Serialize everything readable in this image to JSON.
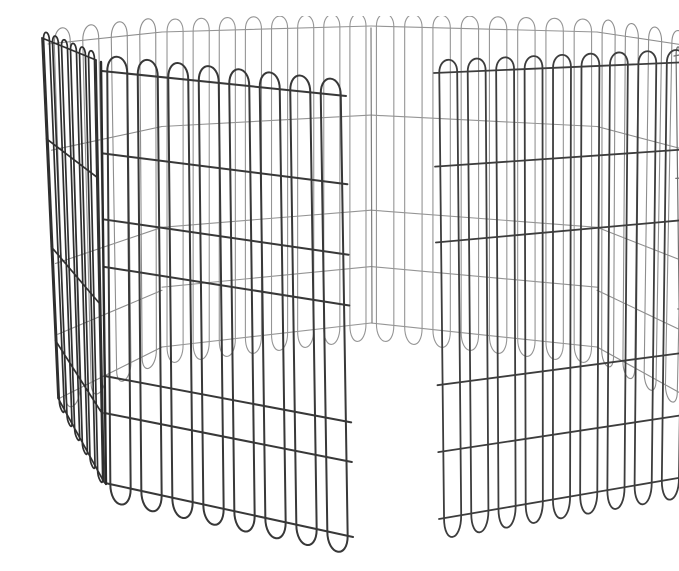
{
  "scene": {
    "alt": "Black metal 8-panel octagonal pet exercise pen with one gate panel swung open inward, photographed on a plain white background",
    "background": "#ffffff",
    "colors": {
      "wire_front": "#383838",
      "wire_door": "#3d3d3d",
      "wire_back": "#959595",
      "wire_diagonal": "#8e8e8e",
      "wire_side_dense": "#2f2f2f",
      "clip_black": "#1c1c1c",
      "corner_post": "#333333",
      "latch_wire": "#2b2b2b"
    }
  },
  "pen": {
    "back_panels": [
      {
        "name": "panel-back-left-diagonal",
        "quad": [
          [
            8,
            28
          ],
          [
            122,
            16
          ],
          [
            122,
            331
          ],
          [
            20,
            382
          ]
        ],
        "loops": 4,
        "pair_gap": 0.14,
        "loop_top": 14,
        "loop_bottom": 13,
        "horizontals": [
          0.3,
          0.62,
          0.82
        ],
        "stroke": "#8e8e8e",
        "width": 1.1,
        "edges": false
      },
      {
        "name": "panel-back-left",
        "quad": [
          [
            122,
            16
          ],
          [
            331,
            10
          ],
          [
            331,
            307
          ],
          [
            122,
            331
          ]
        ],
        "loops": 8,
        "pair_gap": 0.077,
        "loop_top": 12,
        "loop_bottom": 15,
        "horizontals": [
          0.3,
          0.62,
          0.81
        ],
        "stroke": "#959595",
        "width": 1.1,
        "edges": false
      },
      {
        "name": "panel-back-right",
        "quad": [
          [
            331,
            10
          ],
          [
            557,
            16
          ],
          [
            557,
            331
          ],
          [
            331,
            307
          ]
        ],
        "loops": 8,
        "pair_gap": 0.077,
        "loop_top": 12,
        "loop_bottom": 15,
        "horizontals": [
          0.3,
          0.62,
          0.81
        ],
        "stroke": "#959595",
        "width": 1.1,
        "edges": false
      },
      {
        "name": "panel-back-right-diagonal",
        "quad": [
          [
            557,
            16
          ],
          [
            650,
            30
          ],
          [
            642,
            378
          ],
          [
            557,
            331
          ]
        ],
        "loops": 4,
        "pair_gap": 0.14,
        "loop_top": 13,
        "loop_bottom": 12,
        "horizontals": [
          0.3,
          0.62,
          0.82
        ],
        "stroke": "#8e8e8e",
        "width": 1.1,
        "edges": false
      }
    ],
    "back_seam": {
      "name": "back-seam-wire",
      "x1": 331,
      "y1": 12,
      "x2": 332,
      "y2": 307,
      "stroke": "#7d7d7d",
      "width": 1.2
    },
    "mid_panels": [
      {
        "name": "panel-left-side",
        "quad": [
          [
            2,
            22
          ],
          [
            56,
            44
          ],
          [
            64,
            466
          ],
          [
            18,
            382
          ]
        ],
        "loops": 6,
        "pair_gap": 0.11,
        "loop_top": 7,
        "loop_bottom": 5,
        "horizontals": [
          0.28,
          0.58,
          0.84
        ],
        "stroke": "#2f2f2f",
        "width": 1.7,
        "edges": true
      },
      {
        "name": "panel-right-side",
        "quad": [
          [
            634,
            40
          ],
          [
            650,
            37
          ],
          [
            648,
            452
          ],
          [
            640,
            448
          ]
        ],
        "loops": 2,
        "pair_gap": 0.24,
        "loop_top": 8,
        "loop_bottom": 5,
        "horizontals": [
          0.3,
          0.62
        ],
        "stroke": "#707070",
        "width": 1.2,
        "edges": false
      },
      {
        "name": "panel-gate-open",
        "quad": [
          [
            394,
            57
          ],
          [
            650,
            46
          ],
          [
            644,
            461
          ],
          [
            399,
            503
          ]
        ],
        "loops": 9,
        "pair_gap": 0.07,
        "loop_top": 12,
        "loop_bottom": 18,
        "horizontals": [
          0.21,
          0.38,
          0.7,
          0.85
        ],
        "stroke": "#3d3d3d",
        "width": 1.8,
        "edges": false
      }
    ],
    "corner_post": {
      "name": "right-corner-post",
      "points": "664,20 677,23 660,460 650,455",
      "fill": "#333333",
      "highlight": {
        "x1": 669,
        "y1": 28,
        "x2": 656,
        "y2": 450,
        "stroke": "#585858",
        "width": 1.4
      }
    },
    "front_panel": {
      "name": "panel-front-left",
      "quad": [
        [
          62,
          55
        ],
        [
          306,
          80
        ],
        [
          313,
          521
        ],
        [
          65,
          467
        ]
      ],
      "loops": 8,
      "pair_gap": 0.082,
      "loop_top": 15,
      "loop_bottom": 16,
      "horizontals": [
        0.2,
        0.36,
        0.475,
        0.74,
        0.83
      ],
      "stroke": "#383838",
      "width": 2,
      "edges": false
    },
    "edge_wires": [
      {
        "name": "front-left-panel-left-edge",
        "x1": 61,
        "y1": 46,
        "x2": 66,
        "y2": 468,
        "stroke": "#2a2a2a",
        "width": 2.4
      },
      {
        "name": "front-left-panel-right-edge",
        "x1": 305,
        "y1": 62,
        "x2": 314,
        "y2": 523,
        "stroke": "#242424",
        "width": 2.6
      },
      {
        "name": "gate-free-edge",
        "x1": 394,
        "y1": 57,
        "x2": 400,
        "y2": 503,
        "stroke": "#2b2b2b",
        "width": 2.2
      }
    ],
    "clips": [
      {
        "name": "hinge-clip-top-left",
        "x": 118,
        "y": 4,
        "w": 25,
        "h": 13,
        "rot": -3
      },
      {
        "name": "hinge-clip-top-center",
        "x": 318,
        "y": 1,
        "w": 26,
        "h": 13,
        "rot": 0
      },
      {
        "name": "hinge-clip-top-right",
        "x": 527,
        "y": 4,
        "w": 26,
        "h": 13,
        "rot": 4
      },
      {
        "name": "hinge-clip-left-corner",
        "x": 36,
        "y": 35,
        "w": 24,
        "h": 16,
        "rot": 22
      },
      {
        "name": "hinge-clip-right-corner",
        "x": 648,
        "y": 32,
        "w": 26,
        "h": 16,
        "rot": -12
      },
      {
        "name": "clip-right-post-upper",
        "x": 664,
        "y": 140,
        "w": 12,
        "h": 10,
        "rot": -70
      },
      {
        "name": "clip-right-post-mid",
        "x": 653,
        "y": 183,
        "w": 12,
        "h": 10,
        "rot": -70
      },
      {
        "name": "clip-right-post-foot",
        "x": 644,
        "y": 449,
        "w": 10,
        "h": 13,
        "rot": -10
      },
      {
        "name": "clip-left-bottom-corner",
        "x": 14,
        "y": 374,
        "w": 15,
        "h": 11,
        "rot": 35
      },
      {
        "name": "clip-front-left-foot",
        "x": 59,
        "y": 456,
        "w": 11,
        "h": 14,
        "rot": 10
      }
    ],
    "latches": [
      {
        "name": "slide-bolt-latch-top",
        "segments": [
          [
            281,
            64,
            314,
            62,
            1.5
          ],
          [
            281,
            73,
            314,
            71.5,
            1.5
          ],
          [
            308,
            57,
            309,
            88,
            1.8
          ],
          [
            313,
            56,
            314,
            87,
            1.8
          ],
          [
            283,
            60,
            283,
            77,
            1.3
          ],
          [
            288,
            60,
            288,
            77,
            1.3
          ],
          [
            276,
            85,
            317,
            81,
            2.4
          ]
        ]
      },
      {
        "name": "slide-bolt-latch-middle",
        "segments": [
          [
            286,
            291,
            319,
            289,
            1.5
          ],
          [
            286,
            299,
            319,
            297.5,
            1.5
          ],
          [
            313,
            284,
            314,
            311,
            1.8
          ],
          [
            318,
            283,
            319,
            310,
            1.8
          ],
          [
            288,
            287,
            288,
            303,
            1.3
          ],
          [
            293,
            287,
            293,
            303,
            1.3
          ],
          [
            282,
            307,
            321,
            303,
            2.4
          ]
        ]
      },
      {
        "name": "slide-bolt-latch-bottom",
        "segments": [
          [
            292,
            519,
            325,
            516,
            1.5
          ],
          [
            292,
            527,
            325,
            524.5,
            1.5
          ],
          [
            319,
            513,
            320,
            537,
            1.8
          ],
          [
            324,
            512,
            325,
            536,
            1.8
          ],
          [
            294,
            515,
            294,
            531,
            1.3
          ],
          [
            299,
            515,
            299,
            531,
            1.3
          ],
          [
            288,
            534,
            328,
            529,
            2.4
          ]
        ]
      }
    ],
    "chain_links": {
      "name": "connector-chain",
      "points": [
        [
          662,
          54
        ],
        [
          664,
          61
        ],
        [
          661,
          68
        ]
      ],
      "r": 2.2,
      "stroke": "#3a3a3a"
    }
  }
}
